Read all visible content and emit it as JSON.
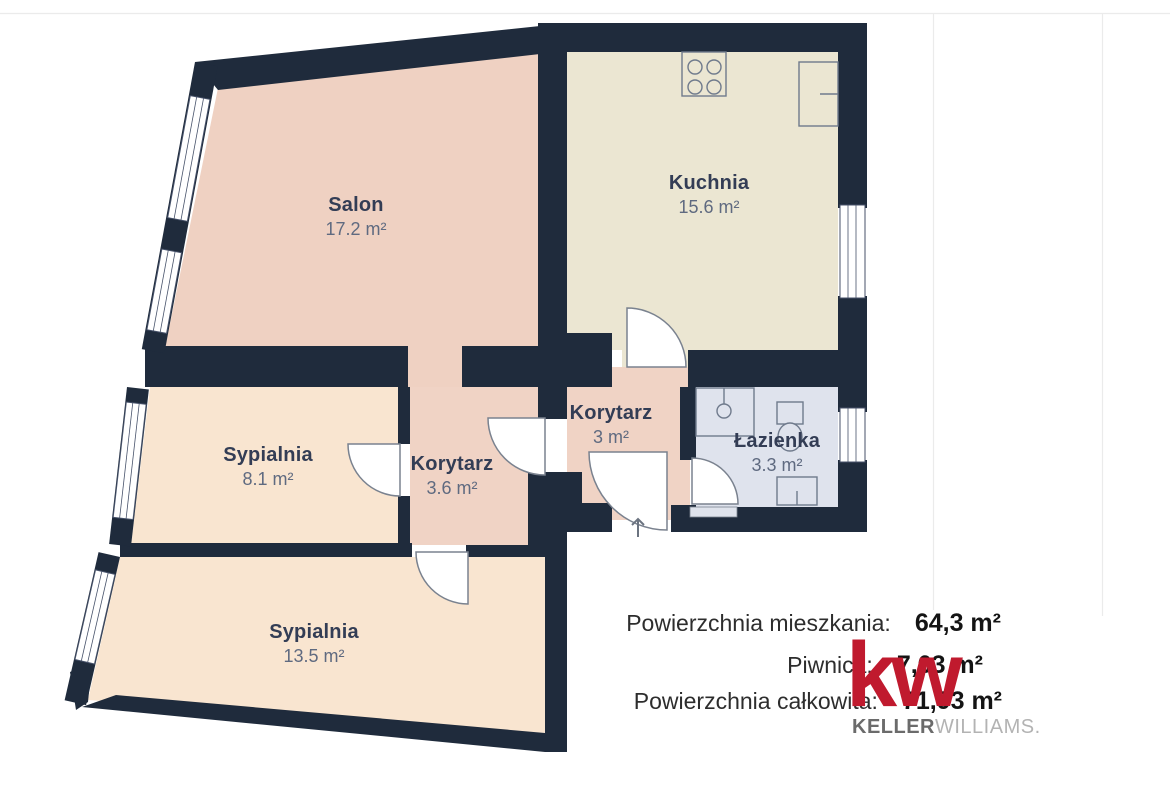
{
  "floorplan": {
    "wall_color": "#1f2b3c",
    "fixture_stroke": "#6f7a8c",
    "frame_line_color": "#ebebeb",
    "rooms": [
      {
        "id": "salon",
        "name": "Salon",
        "area": "17.2 m²",
        "fill": "#efd1c2"
      },
      {
        "id": "kuchnia",
        "name": "Kuchnia",
        "area": "15.6 m²",
        "fill": "#ebe6d2"
      },
      {
        "id": "sypialnia-1",
        "name": "Sypialnia",
        "area": "8.1 m²",
        "fill": "#f9e5d0"
      },
      {
        "id": "korytarz-1",
        "name": "Korytarz",
        "area": "3.6 m²",
        "fill": "#f0d3c5"
      },
      {
        "id": "korytarz-2",
        "name": "Korytarz",
        "area": "3 m²",
        "fill": "#f0d3c5"
      },
      {
        "id": "lazienka",
        "name": "Łazienka",
        "area": "3.3 m²",
        "fill": "#dfe3ed"
      },
      {
        "id": "sypialnia-2",
        "name": "Sypialnia",
        "area": "13.5 m²",
        "fill": "#f9e5d0"
      }
    ],
    "fixtures": [
      "stove-icon",
      "fridge-icon",
      "shower-icon",
      "toilet-icon",
      "washing-machine-icon",
      "entrance-arrow-icon"
    ]
  },
  "summary": {
    "rows": [
      {
        "label": "Powierzchnia mieszkania:",
        "value": "64,3 m²"
      },
      {
        "label": "Piwnica:",
        "value": "7,63 m²"
      },
      {
        "label": "Powierzchnia całkowita:",
        "value": "71,93 m²"
      }
    ]
  },
  "branding": {
    "monogram": "kw",
    "name_primary": "KELLER",
    "name_secondary": "WILLIAMS",
    "name_suffix": ".",
    "logo_color": "#c01a2e"
  }
}
